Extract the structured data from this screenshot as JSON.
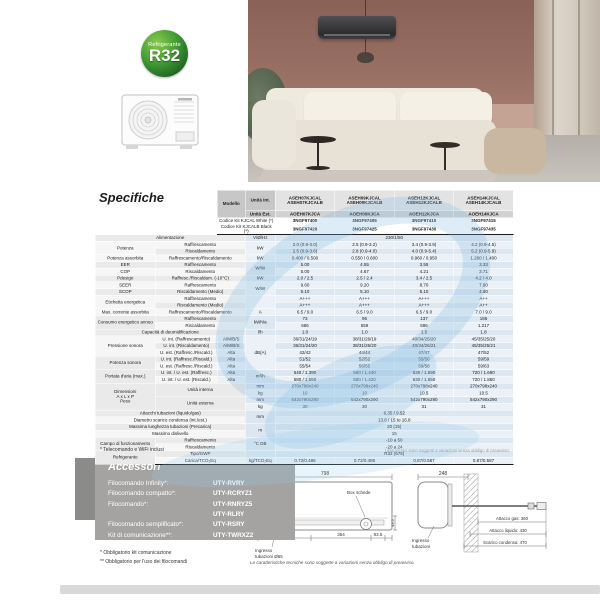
{
  "badge": {
    "top": "Refrigerante",
    "main": "R32"
  },
  "specs": {
    "title": "Specifiche",
    "footnote_left": "* Telecomando e WiFi inclusi",
    "footnote_right": "I dati tecnici sono soggetti a variazioni senza obbligo di preavviso.",
    "table": {
      "head": [
        [
          [
            "",
            "hb",
            2,
            4
          ],
          [
            "Modello",
            "hl",
            1,
            2
          ],
          [
            "Unità Int.",
            "hl"
          ],
          [
            "ASEH07KJCAL\nASEH07KJCALB",
            "hm"
          ],
          [
            "ASEH09KJCAL\nASEH09KJCALB",
            "hm"
          ],
          [
            "ASEH12KJCAL\nASEH12KJCALB",
            "hm"
          ],
          [
            "ASEH14KJCAL\nASEH14KJCALB",
            "hm"
          ]
        ],
        [
          [
            "Unità Est.",
            "hl"
          ],
          [
            "AOEH07KJCA",
            "hm2"
          ],
          [
            "AOEH09KJCA",
            "hm2"
          ],
          [
            "AOEH12KJCA",
            "hm2"
          ],
          [
            "AOEH14KJCA",
            "hm2"
          ]
        ],
        [
          [
            "Codice Kit KJCAL White (*)",
            "hc",
            2
          ],
          [
            "3NGF97400",
            "hcode"
          ],
          [
            "3NGF97405",
            "hcode"
          ],
          [
            "3NGF97410",
            "hcode"
          ],
          [
            "3NGF97415",
            "hcode"
          ]
        ],
        [
          [
            "Codice Kit KJCALB Black (*)",
            "hc",
            2
          ],
          [
            "3NGF97420",
            "hcode"
          ],
          [
            "3NGF97425",
            "hcode"
          ],
          [
            "3NGF97430",
            "hcode"
          ],
          [
            "3NGF97435",
            "hcode"
          ]
        ]
      ],
      "rows": [
        [
          [
            "Alimentazione",
            "c1l",
            3
          ],
          [
            "V/Ø/Hz",
            "u"
          ],
          [
            "230/1/50",
            "vs",
            4
          ]
        ],
        [
          [
            "Potenza",
            "c1",
            1,
            2
          ],
          [
            "Raffrescamento",
            "c2",
            2
          ],
          [
            "kW",
            "u",
            1,
            2
          ],
          [
            "2.0 (0.9-3.0)",
            "v"
          ],
          [
            "2.5 (0.9-3.2)",
            "v"
          ],
          [
            "3.4 (0.9-3.9)",
            "v"
          ],
          [
            "4.2 (0.9-4.5)",
            "v"
          ]
        ],
        [
          [
            "Riscaldamento",
            "c2",
            2
          ],
          [
            "2.5 (0.9-3.6)",
            "v"
          ],
          [
            "2.8 (0.9-4.0)",
            "v"
          ],
          [
            "4.0 (0.9-5.4)",
            "v"
          ],
          [
            "5.2 (0.9-5.9)",
            "v"
          ]
        ],
        [
          [
            "Potenza assorbita",
            "c1"
          ],
          [
            "Raffrescamento/Riscaldamento",
            "c2",
            2
          ],
          [
            "kW",
            "u"
          ],
          [
            "0.400 / 0.500",
            "v"
          ],
          [
            "0.550 / 0.600",
            "v"
          ],
          [
            "0.960 / 0.950",
            "v"
          ],
          [
            "1.260 / 1.400",
            "v"
          ]
        ],
        [
          [
            "EER",
            "c1"
          ],
          [
            "Raffrescamento",
            "c2",
            2
          ],
          [
            "W/W",
            "u",
            1,
            2
          ],
          [
            "5.00",
            "v"
          ],
          [
            "4.55",
            "v"
          ],
          [
            "3.55",
            "v"
          ],
          [
            "3.33",
            "v"
          ]
        ],
        [
          [
            "COP",
            "c1"
          ],
          [
            "Riscaldamento",
            "c2",
            2
          ],
          [
            "5.00",
            "v"
          ],
          [
            "4.67",
            "v"
          ],
          [
            "4.21",
            "v"
          ],
          [
            "3.71",
            "v"
          ]
        ],
        [
          [
            "Pdesign",
            "c1"
          ],
          [
            "Raffresc./Riscaldam. (-10°C)",
            "c2",
            2
          ],
          [
            "kW",
            "u"
          ],
          [
            "2.0 / 2.5",
            "v"
          ],
          [
            "2.5 / 2.4",
            "v"
          ],
          [
            "3.4 / 2.5",
            "v"
          ],
          [
            "4.2 / 4.0",
            "v"
          ]
        ],
        [
          [
            "SEER",
            "c1"
          ],
          [
            "Raffrescamento",
            "c2",
            2
          ],
          [
            "W/W",
            "u",
            1,
            2
          ],
          [
            "9.60",
            "v"
          ],
          [
            "9.20",
            "v"
          ],
          [
            "8.70",
            "v"
          ],
          [
            "7.90",
            "v"
          ]
        ],
        [
          [
            "SCOP",
            "c1"
          ],
          [
            "Riscaldamento (Medio)",
            "c2",
            2
          ],
          [
            "5.10",
            "v"
          ],
          [
            "5.10",
            "v"
          ],
          [
            "5.10",
            "v"
          ],
          [
            "4.60",
            "v"
          ]
        ],
        [
          [
            "Etichetta energetica",
            "c1",
            1,
            2
          ],
          [
            "Raffrescamento",
            "c2",
            2
          ],
          [
            "",
            "u",
            1,
            2
          ],
          [
            "A+++",
            "v"
          ],
          [
            "A+++",
            "v"
          ],
          [
            "A+++",
            "v"
          ],
          [
            "A++",
            "v"
          ]
        ],
        [
          [
            "Riscaldamento (Medio)",
            "c2",
            2
          ],
          [
            "A+++",
            "v"
          ],
          [
            "A+++",
            "v"
          ],
          [
            "A+++",
            "v"
          ],
          [
            "A++",
            "v"
          ]
        ],
        [
          [
            "Max. corrente assorbita",
            "c1"
          ],
          [
            "Raffrescamento/Riscaldamento",
            "c2",
            2
          ],
          [
            "A",
            "u"
          ],
          [
            "6.5 / 9.0",
            "v"
          ],
          [
            "6.5 / 9.0",
            "v"
          ],
          [
            "6.5 / 9.0",
            "v"
          ],
          [
            "7.0 / 9.0",
            "v"
          ]
        ],
        [
          [
            "Consumo energetico annuo",
            "c1",
            1,
            2
          ],
          [
            "Raffrescamento",
            "c2",
            2
          ],
          [
            "kWh/a",
            "u",
            1,
            2
          ],
          [
            "73",
            "v"
          ],
          [
            "95",
            "v"
          ],
          [
            "137",
            "v"
          ],
          [
            "186",
            "v"
          ]
        ],
        [
          [
            "Riscaldamento",
            "c2",
            2
          ],
          [
            "686",
            "v"
          ],
          [
            "659",
            "v"
          ],
          [
            "686",
            "v"
          ],
          [
            "1.217",
            "v"
          ]
        ],
        [
          [
            "Capacità di deumidificazione",
            "c1l",
            3
          ],
          [
            "l/h",
            "u"
          ],
          [
            "1.0",
            "v"
          ],
          [
            "1.0",
            "v"
          ],
          [
            "1.5",
            "v"
          ],
          [
            "1.8",
            "v"
          ]
        ],
        [
          [
            "Pressione sonora",
            "c1",
            1,
            3
          ],
          [
            "U. int. (Raffrescamento)",
            "c2"
          ],
          [
            "A/M/B/S",
            "sub"
          ],
          [
            "dB(A)",
            "u",
            1,
            5
          ],
          [
            "36/31/24/19",
            "v"
          ],
          [
            "38/31/26/19",
            "v"
          ],
          [
            "40/34/25/20",
            "v"
          ],
          [
            "45/35/25/20",
            "v"
          ]
        ],
        [
          [
            "U. int. (Riscaldamento)",
            "c2"
          ],
          [
            "A/M/B/S",
            "sub"
          ],
          [
            "36/31/24/20",
            "v"
          ],
          [
            "38/31/26/20",
            "v"
          ],
          [
            "40/34/25/21",
            "v"
          ],
          [
            "45/35/25/21",
            "v"
          ]
        ],
        [
          [
            "U. est. (Raffresc./Riscald.)",
            "c2"
          ],
          [
            "Alta",
            "sub"
          ],
          [
            "42/42",
            "v"
          ],
          [
            "44/44",
            "v"
          ],
          [
            "47/47",
            "v"
          ],
          [
            "47/52",
            "v"
          ]
        ],
        [
          [
            "Potenza sonora",
            "c1",
            1,
            2
          ],
          [
            "U. int. (Raffresc./Riscald.)",
            "c2"
          ],
          [
            "Alta",
            "sub"
          ],
          [
            "51/52",
            "v"
          ],
          [
            "52/52",
            "v"
          ],
          [
            "55/56",
            "v"
          ],
          [
            "59/59",
            "v"
          ]
        ],
        [
          [
            "U. est. (Raffresc./Riscald.)",
            "c2"
          ],
          [
            "Alta",
            "sub"
          ],
          [
            "55/54",
            "v"
          ],
          [
            "56/55",
            "v"
          ],
          [
            "59/58",
            "v"
          ],
          [
            "59/63",
            "v"
          ]
        ],
        [
          [
            "Portata d'aria (max.)",
            "c1",
            1,
            2
          ],
          [
            "U. int. / U. est. (Raffresc.)",
            "c2"
          ],
          [
            "Alta",
            "sub"
          ],
          [
            "m³/h",
            "u",
            1,
            2
          ],
          [
            "540 / 1.390",
            "v"
          ],
          [
            "560 / 1.440",
            "v"
          ],
          [
            "630 / 1.690",
            "v"
          ],
          [
            "720 / 1.690",
            "v"
          ]
        ],
        [
          [
            "U. int. / U. est. (Riscald.)",
            "c2"
          ],
          [
            "Alta",
            "sub"
          ],
          [
            "580 / 1.550",
            "v"
          ],
          [
            "580 / 1.420",
            "v"
          ],
          [
            "630 / 1.650",
            "v"
          ],
          [
            "720 / 1.860",
            "v"
          ]
        ],
        [
          [
            "Dimensioni\nA x L x P\nPeso",
            "c1",
            1,
            4
          ],
          [
            "Unità interna",
            "c2",
            2,
            2
          ],
          [
            "mm",
            "u"
          ],
          [
            "270x798x240",
            "v"
          ],
          [
            "270x798x240",
            "v"
          ],
          [
            "270x798x240",
            "v"
          ],
          [
            "270x798x240",
            "v"
          ]
        ],
        [
          [
            "kg",
            "u"
          ],
          [
            "10",
            "v"
          ],
          [
            "10",
            "v"
          ],
          [
            "10.5",
            "v"
          ],
          [
            "10.5",
            "v"
          ]
        ],
        [
          [
            "Unità esterna",
            "c2",
            2,
            2
          ],
          [
            "mm",
            "u"
          ],
          [
            "542x790x290",
            "v"
          ],
          [
            "542x790x290",
            "v"
          ],
          [
            "542x790x290",
            "v"
          ],
          [
            "542x790x290",
            "v"
          ]
        ],
        [
          [
            "kg",
            "u"
          ],
          [
            "30",
            "v"
          ],
          [
            "30",
            "v"
          ],
          [
            "31",
            "v"
          ],
          [
            "31",
            "v"
          ]
        ],
        [
          [
            "Attacchi tubazioni (liquido/gas)",
            "c1l",
            3
          ],
          [
            "mm",
            "u",
            1,
            2
          ],
          [
            "6.35 / 9.52",
            "vs",
            4
          ]
        ],
        [
          [
            "Diametro scarico condensa (int./est.)",
            "c1l",
            3
          ],
          [
            "13.8 / 15 to 16.8",
            "vs",
            4
          ]
        ],
        [
          [
            "Massima lunghezza tubazioni (Precarica)",
            "c1l",
            3
          ],
          [
            "m",
            "u",
            1,
            2
          ],
          [
            "20 (15)",
            "vs",
            4
          ]
        ],
        [
          [
            "Massimo dislivello",
            "c1l",
            3
          ],
          [
            "15",
            "vs",
            4
          ]
        ],
        [
          [
            "Campo di funzionamento",
            "c1",
            1,
            2
          ],
          [
            "Raffrescamento",
            "c2",
            2
          ],
          [
            "°C DB",
            "u",
            1,
            2
          ],
          [
            "-10 a 50",
            "vs",
            4
          ]
        ],
        [
          [
            "Riscaldamento",
            "c2",
            2
          ],
          [
            "-20 a 24",
            "vs",
            4
          ]
        ],
        [
          [
            "Refrigerante",
            "c1",
            1,
            2
          ],
          [
            "Tipo/GWP",
            "c2",
            2
          ],
          [
            "",
            "u"
          ],
          [
            "R32 (675)",
            "vs",
            4
          ]
        ],
        [
          [
            "Carica/TCO₂Eq",
            "c2",
            2
          ],
          [
            "kg/TCO₂Eq",
            "u"
          ],
          [
            "0.72/0.486",
            "v"
          ],
          [
            "0.72/0.486",
            "v"
          ],
          [
            "0.87/0.587",
            "v"
          ],
          [
            "0.87/0.587",
            "v"
          ]
        ]
      ]
    }
  },
  "accessori": {
    "title": "Accessori",
    "items": [
      {
        "label": "Filocomando Infinity*:",
        "code": "UTY-RVRY"
      },
      {
        "label": "Filocomando compatto*:",
        "code": "UTY-RCRYZ1"
      },
      {
        "label": "Filocomando*:",
        "code": "UTY-RNRYZ5"
      },
      {
        "label": "",
        "code": "UTY-RLRY"
      },
      {
        "label": "Filocomando semplificato*:",
        "code": "UTY-RSRY"
      },
      {
        "label": "Kit di comunicazione**:",
        "code": "UTY-TWRXZ2"
      }
    ],
    "notes": [
      "* Obbligatorio kit comunicazione",
      "** Obbligatorio per l'uso dei filocomandi"
    ]
  },
  "dimensioni": {
    "title": "Dimensioni",
    "unit": "(mm)",
    "front": {
      "width": "798",
      "height": "270",
      "d1": "317.5",
      "d2": "354",
      "d3": "83.5",
      "d4": "43.5",
      "callout_top": "Box schede",
      "callout_bottom1": "Ingresso",
      "callout_bottom2": "tubazioni Ø65"
    },
    "side": {
      "depth": "248",
      "callout1": "Ingresso",
      "callout2": "tubazioni",
      "gas": "Attacco gas: 360",
      "liquido": "Attacco liquido: 430",
      "condensa": "Scarico condensa: 470"
    },
    "note": "Le caratteristiche tecniche sono soggette a variazioni senza obbligo di preavviso."
  }
}
